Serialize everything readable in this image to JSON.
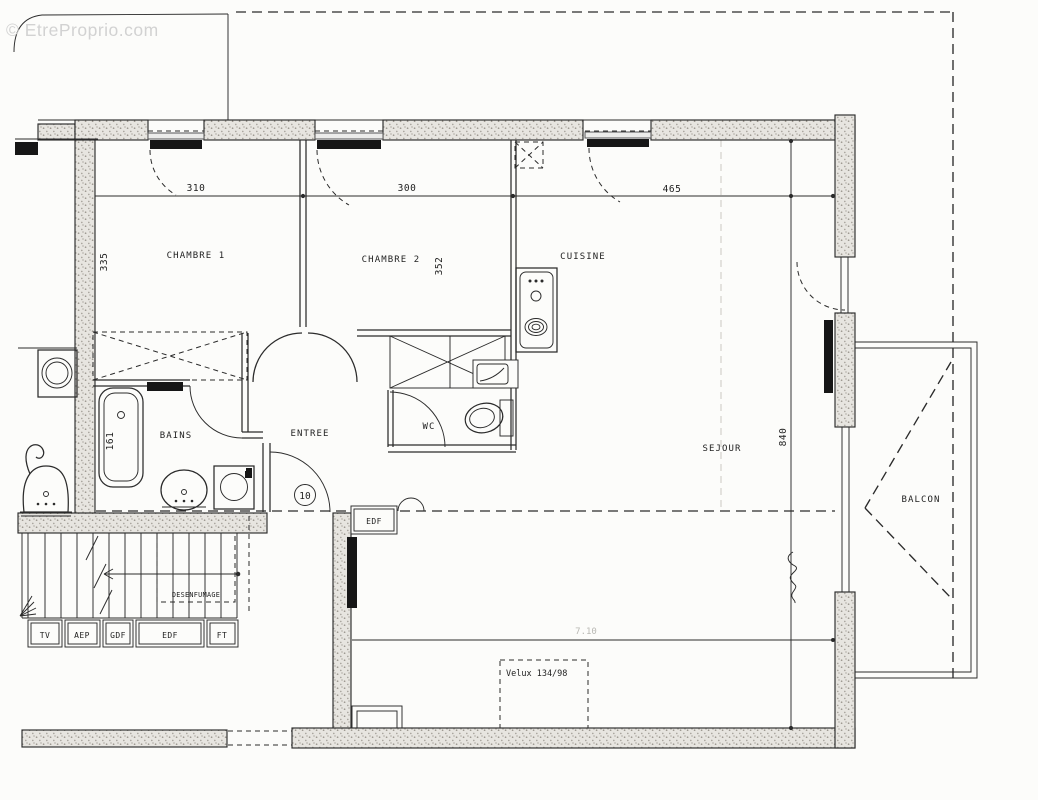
{
  "watermark": "© EtreProprio.com",
  "rooms": {
    "chambre1": "CHAMBRE 1",
    "chambre2": "CHAMBRE 2",
    "cuisine": "CUISINE",
    "sejour": "SEJOUR",
    "bains": "BAINS",
    "entree": "ENTREE",
    "wc": "WC",
    "balcon": "BALCON"
  },
  "dims": {
    "w_chambre1": "310",
    "w_chambre2": "300",
    "w_sejour": "465",
    "h_chambre1": "335",
    "h_chambre2": "352",
    "h_bain": "161",
    "h_sejour": "840",
    "w_lower_faint": "7.10"
  },
  "utility_boxes": [
    "TV",
    "AEP",
    "GDF",
    "EDF",
    "FT"
  ],
  "annotations": {
    "desenfumage": "DESENFUMAGE",
    "edf_meter": "EDF",
    "velux": "Velux 134/98",
    "door_number": "10"
  },
  "colors": {
    "line": "#2b2b2b",
    "paper": "#fcfcfa",
    "wm": "#d2d2d2",
    "wallfill": "#e7e5e0"
  }
}
